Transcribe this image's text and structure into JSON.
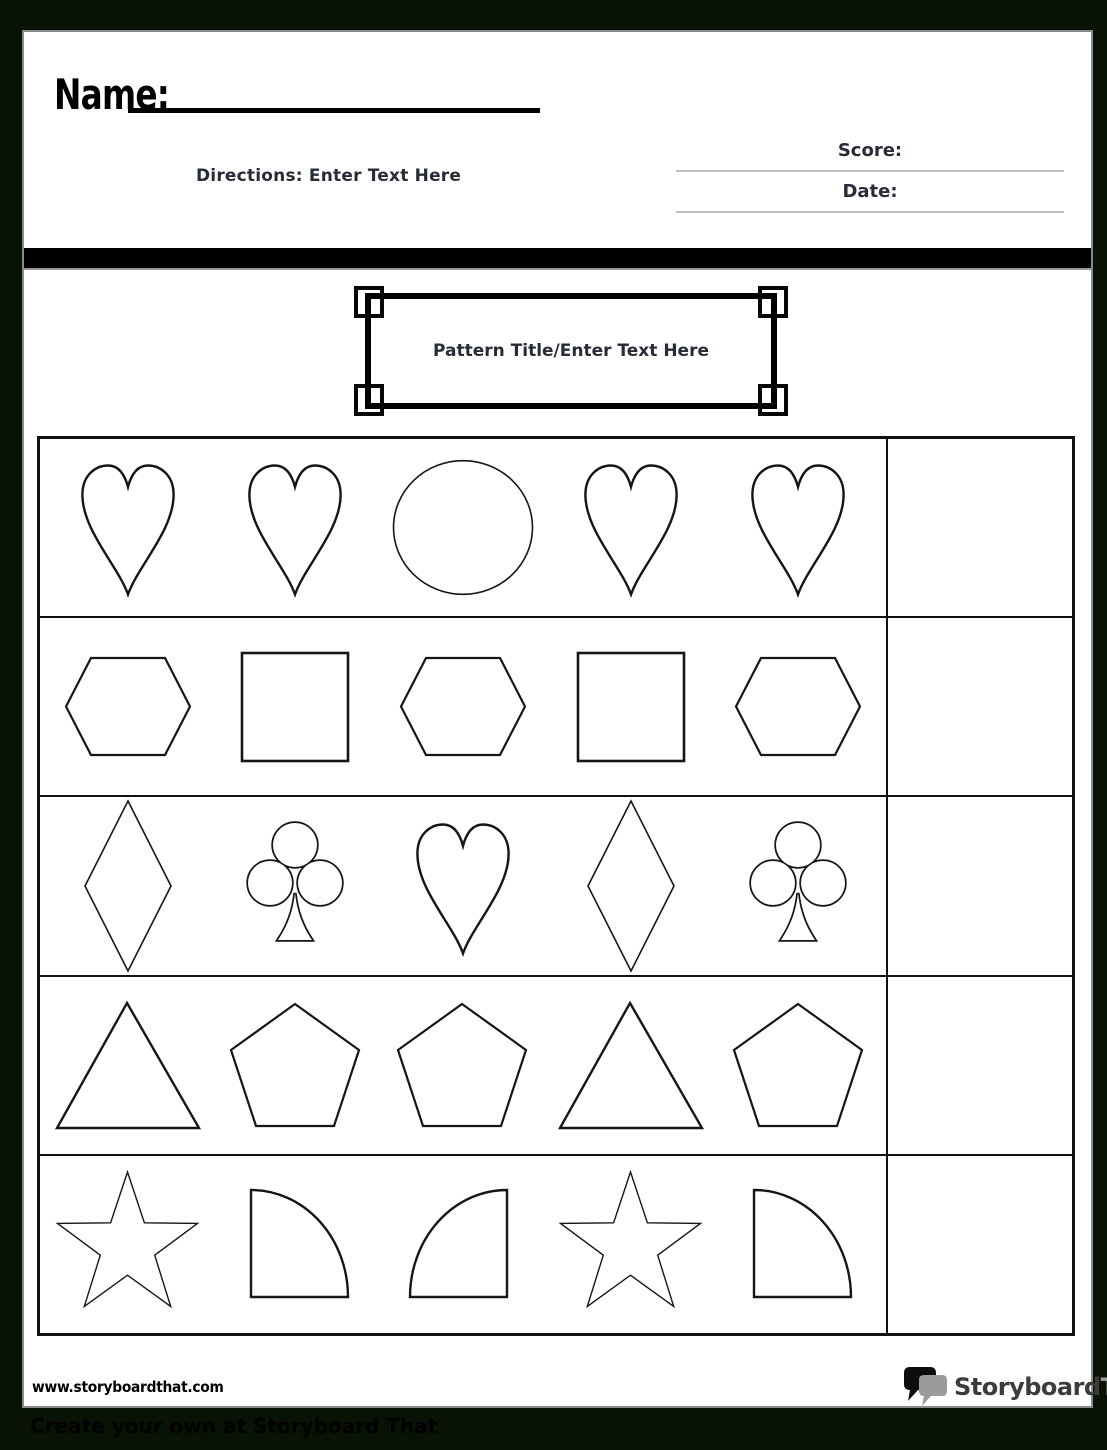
{
  "header": {
    "name_label": "Name:",
    "directions": "Directions: Enter Text Here",
    "score_label": "Score:",
    "date_label": "Date:"
  },
  "title_box": {
    "text": "Pattern Title/Enter Text Here"
  },
  "pattern_grid": {
    "columns": [
      "pattern-shapes",
      "answer-box"
    ],
    "rows": [
      {
        "shapes": [
          "heart",
          "heart",
          "circle",
          "heart",
          "heart"
        ],
        "answer": ""
      },
      {
        "shapes": [
          "hexagon",
          "square",
          "hexagon",
          "square",
          "hexagon"
        ],
        "answer": ""
      },
      {
        "shapes": [
          "diamond",
          "club",
          "heart",
          "diamond",
          "club"
        ],
        "answer": ""
      },
      {
        "shapes": [
          "triangle",
          "pentagon",
          "pentagon",
          "triangle",
          "pentagon"
        ],
        "answer": ""
      },
      {
        "shapes": [
          "star",
          "quarter-circle-right",
          "quarter-circle-left",
          "star",
          "quarter-circle-right"
        ],
        "answer": ""
      }
    ]
  },
  "footer": {
    "website": "www.storyboardthat.com",
    "logo_icon": "speech-bubbles-icon",
    "logo_primary": "Storyboard",
    "logo_secondary": "That"
  },
  "bottom_bar": {
    "text": "Create your own at Storyboard That"
  },
  "colors": {
    "canvas_background": "#081205",
    "page_background": "#ffffff",
    "bar_color": "#000000",
    "text_dark": "#272c36",
    "shape_stroke": "#161616",
    "line_gray": "#bdbdbd",
    "logo_gray": "#9e9e9e"
  }
}
